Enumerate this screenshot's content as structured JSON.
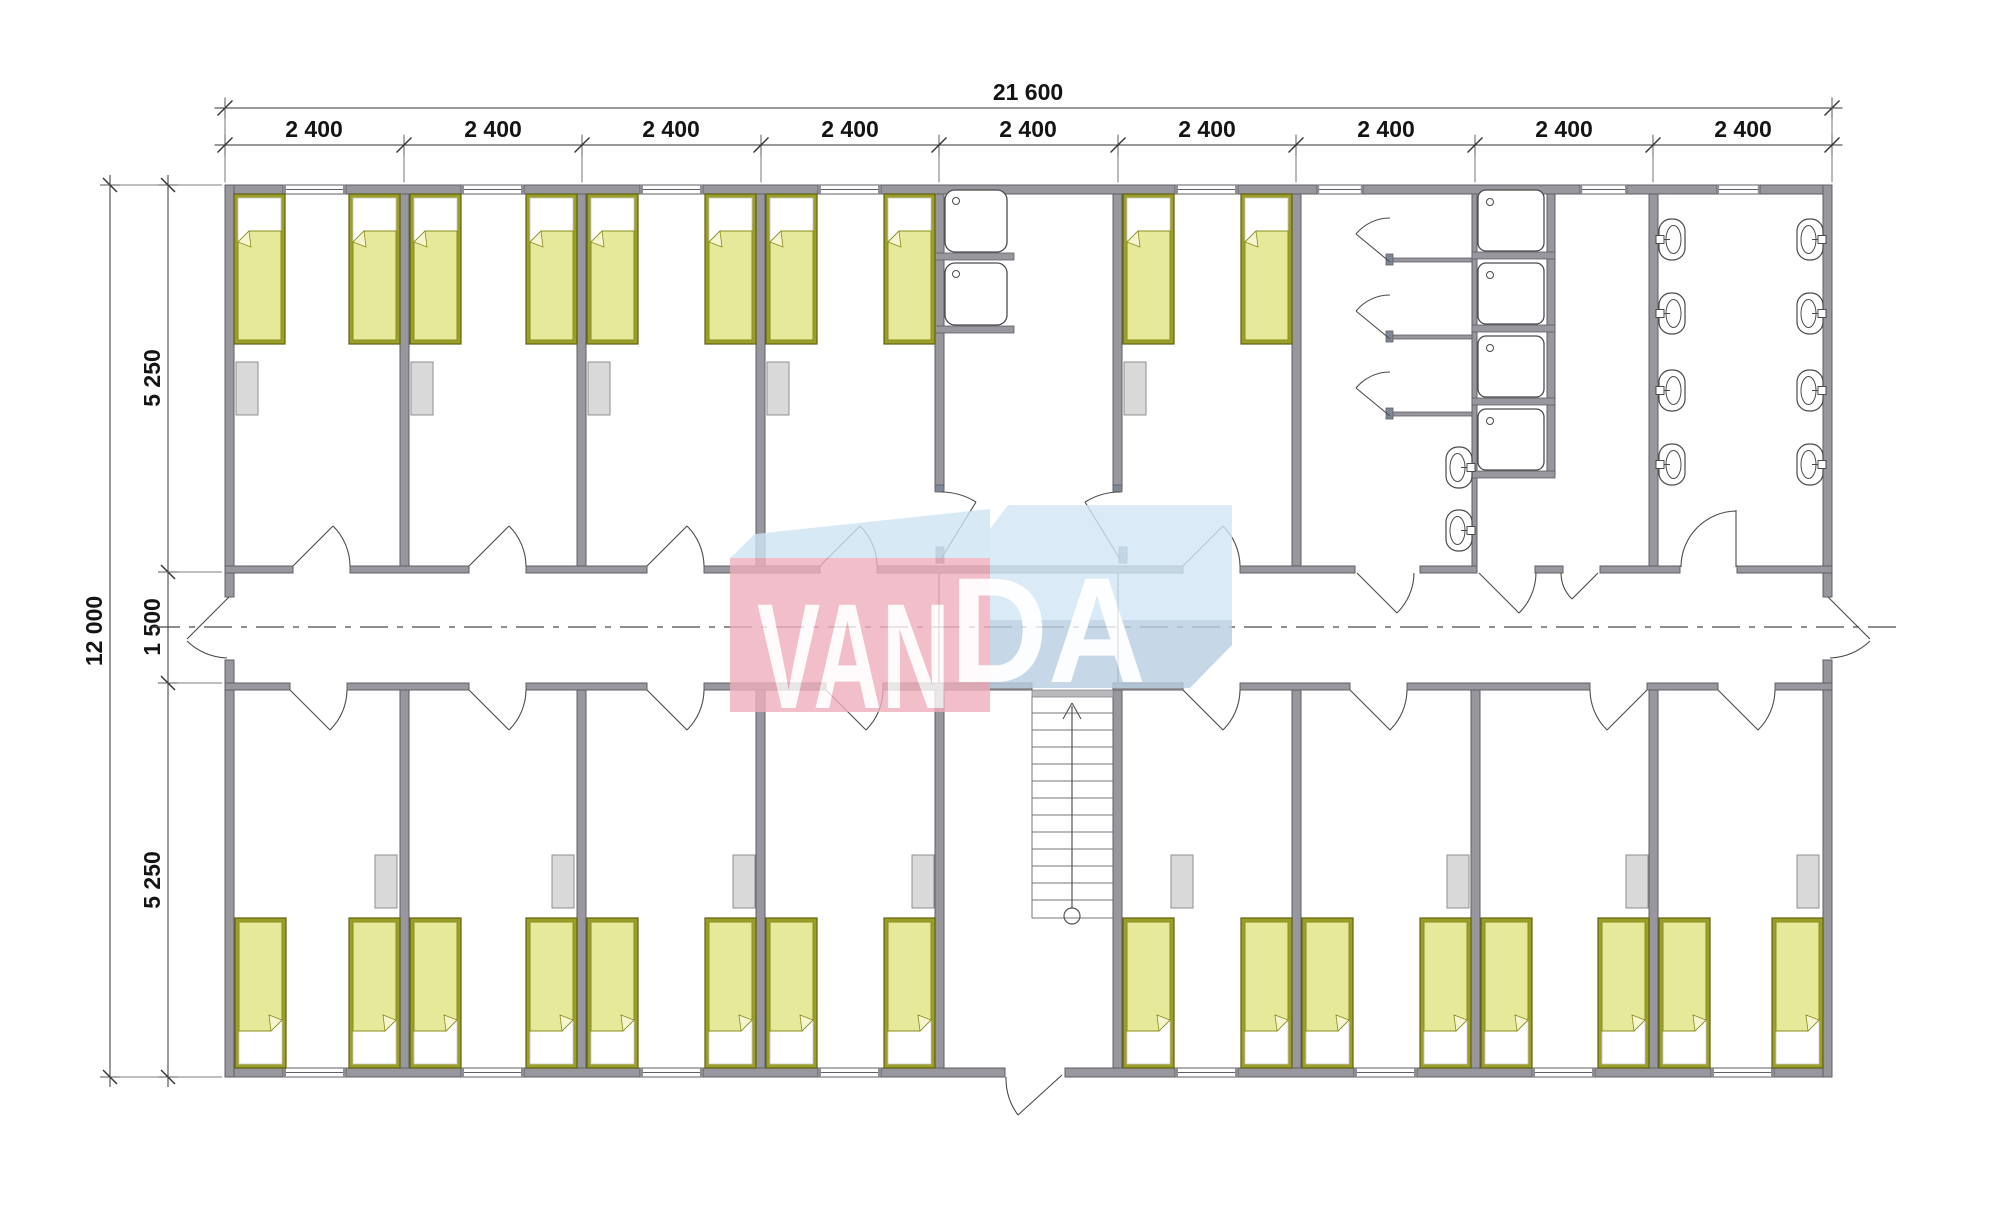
{
  "drawing": {
    "type": "modular building floor plan",
    "watermark_brand": "VANDA"
  },
  "dimensions": {
    "top_total": "21 600",
    "top_segments": [
      "2 400",
      "2 400",
      "2 400",
      "2 400",
      "2 400",
      "2 400",
      "2 400",
      "2 400",
      "2 400"
    ],
    "left_total": "12 000",
    "left_segments": [
      "5 250",
      "1 500",
      "5 250"
    ]
  },
  "watermark": {
    "van": "VAN",
    "da": "DA",
    "colors": {
      "pink": "#efaebc",
      "blue_light": "#d2e7f6",
      "blue_mid": "#b9cfe2",
      "top_face": "#cfe4f4",
      "text": "#ffffff"
    }
  },
  "palette": {
    "wall_fill": "#97979d",
    "wall_edge": "#5f5f66",
    "bed_frame": "#9b9e29",
    "bed_blanket": "#e7e99a",
    "bed_pillow": "#ffffff",
    "locker": "#d9d9d9",
    "fixture_line": "#4a4a4a",
    "dimension_line": "#333333"
  },
  "inventory": {
    "beds": 26,
    "lockers": 13,
    "kitchen_sinks": 2,
    "shower_trays": 4,
    "wc_stalls": 3,
    "wash_basins": 10,
    "stairs": 1,
    "corridor": 1
  }
}
